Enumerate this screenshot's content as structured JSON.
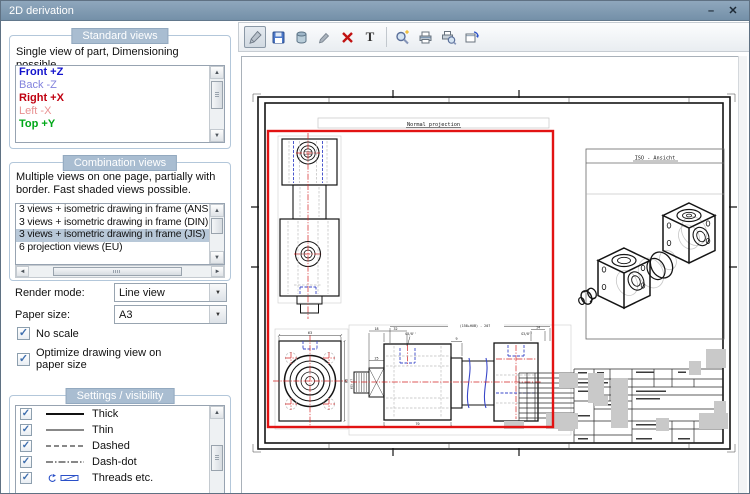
{
  "window": {
    "title": "2D derivation",
    "minimize_glyph": "–",
    "close_glyph": "✕"
  },
  "standard_views": {
    "header": "Standard views",
    "description": "Single view of part, Dimensioning possible.",
    "items": [
      {
        "label": "Front +Z",
        "color": "#1414cc"
      },
      {
        "label": "Back -Z",
        "color": "#8282dd"
      },
      {
        "label": "Right +X",
        "color": "#c00010"
      },
      {
        "label": "Left -X",
        "color": "#e89090"
      },
      {
        "label": "Top +Y",
        "color": "#00a818"
      }
    ]
  },
  "combination_views": {
    "header": "Combination views",
    "description": "Multiple views on one page, partially with border. Fast shaded views possible.",
    "items": [
      {
        "label": "3 views + isometric drawing in frame (ANSI)"
      },
      {
        "label": "3 views + isometric drawing in frame (DIN)"
      },
      {
        "label": "3 views + isometric drawing in frame (JIS)"
      },
      {
        "label": "6 projection views (EU)"
      }
    ],
    "selected": "3 views + isometric drawing in frame (JIS)"
  },
  "options": {
    "render_mode": {
      "label": "Render mode:",
      "value": "Line view"
    },
    "paper_size": {
      "label": "Paper size:",
      "value": "A3"
    },
    "no_scale": {
      "label": "No scale",
      "checked": true
    },
    "optimize": {
      "label": "Optimize drawing view on paper size",
      "checked": true
    }
  },
  "settings_visibility": {
    "header": "Settings / visibility",
    "items": [
      {
        "label": "Thick",
        "checked": true
      },
      {
        "label": "Thin",
        "checked": true
      },
      {
        "label": "Dashed",
        "checked": true
      },
      {
        "label": "Dash-dot",
        "checked": true
      },
      {
        "label": "Threads etc.",
        "checked": true
      }
    ]
  },
  "toolbar": {
    "buttons": [
      {
        "name": "edit",
        "icon": "pen-icon",
        "pressed": true
      },
      {
        "name": "save",
        "icon": "save-icon"
      },
      {
        "name": "export",
        "icon": "database-icon"
      },
      {
        "name": "draw",
        "icon": "pen-small-icon"
      },
      {
        "name": "delete",
        "icon": "delete-icon"
      },
      {
        "name": "text",
        "icon": "text-icon",
        "glyph": "T"
      },
      {
        "name": "zoom",
        "icon": "zoom-icon"
      },
      {
        "name": "print",
        "icon": "print-icon"
      },
      {
        "name": "print-preview",
        "icon": "print-preview-icon"
      },
      {
        "name": "page-setup",
        "icon": "page-setup-icon"
      }
    ]
  },
  "preview": {
    "normal_projection_label": "Normal projection",
    "iso_label": "ISO - Ansicht",
    "dims": {
      "top_total": "(158+HUB) - 207",
      "d18": "18",
      "d32": "32",
      "d25": "25",
      "d9": "9",
      "d14": "14",
      "g38_left": "G3/8''",
      "g38_right": "G3/8''",
      "d63": "63",
      "d85": "85",
      "d70": "70",
      "shaft": "Ø25 f7"
    }
  },
  "icons": {
    "check": "✓",
    "dropdown_arrow": "▼",
    "scroll_up": "▲",
    "scroll_down": "▼",
    "scroll_left": "◄",
    "scroll_right": "►"
  },
  "colors": {
    "selection": "#b8c8d8",
    "red_frame": "#e21313",
    "titlebar": "#7f98b0",
    "group_header": "#a9bdd1"
  }
}
